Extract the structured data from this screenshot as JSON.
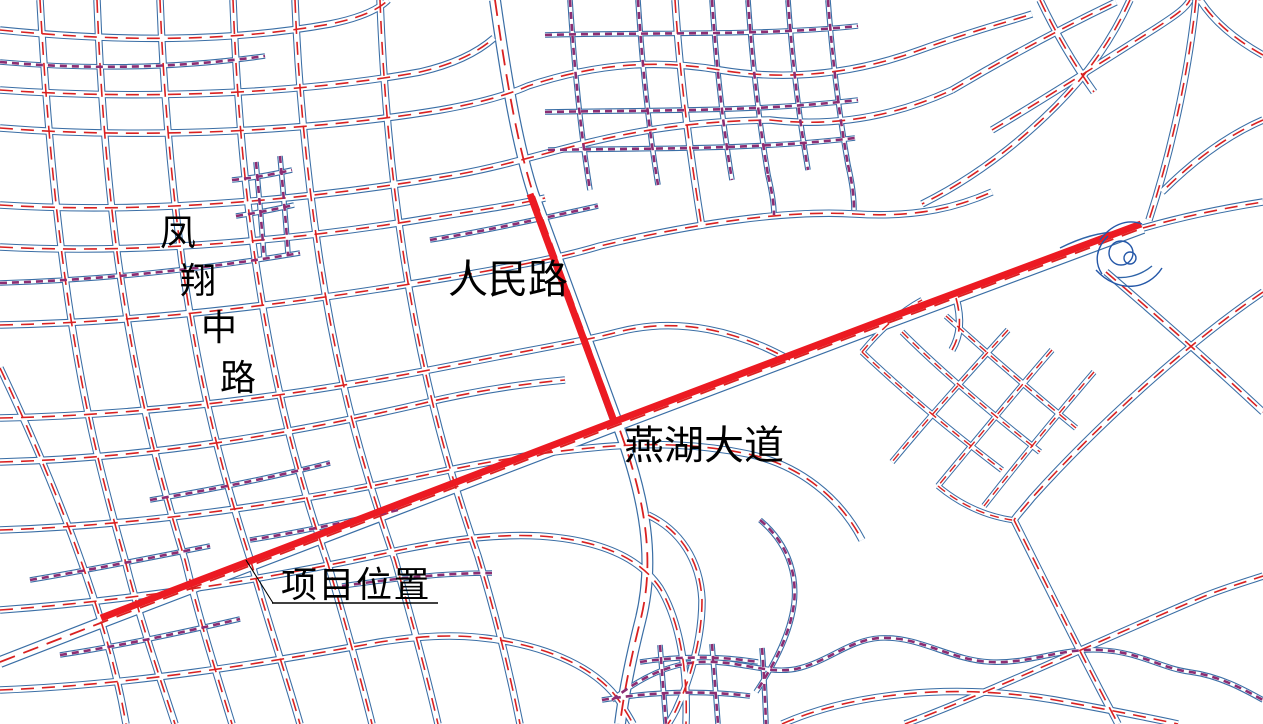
{
  "page": {
    "background": "#ffffff",
    "width": 1263,
    "height": 724
  },
  "colors": {
    "road_edge_blue": "#3a6ea5",
    "centerline_red": "#d92121",
    "minor_street_purple": "#8c2d72",
    "highlight_red": "#ec1a22",
    "label_black": "#000000"
  },
  "labels": {
    "fengxiang_road": {
      "text": "凤翔中路",
      "chars": [
        "凤",
        "翔",
        "中",
        "路"
      ]
    },
    "renmin_road": {
      "text": "人民路"
    },
    "yanhu_avenue": {
      "text": "燕湖大道"
    },
    "project_location": {
      "text": "项目位置"
    }
  },
  "map": {
    "highlight_route_names": [
      "人民路",
      "燕湖大道"
    ],
    "annotation": {
      "leader_d": "M246,560 L273,603",
      "underline_d": "M272,603 L438,603"
    },
    "highlights": [
      "M101,618 L616,421 L878,322 L1141,224",
      "M530,194 L615,424"
    ],
    "interchange": {
      "circles": [
        {
          "cx": 1121,
          "cy": 253,
          "r": 12
        },
        {
          "cx": 1130,
          "cy": 258,
          "r": 6
        }
      ],
      "ramps": [
        "M1096,270 C1118,294 1148,290 1162,268",
        "M1100,240 C1110,226 1126,218 1142,224",
        "M1108,236 C1096,248 1094,262 1102,274"
      ]
    },
    "roads": [
      {
        "c": "M",
        "d": "M0,662 L103,622 L618,425 L880,326 L1143,228"
      },
      {
        "c": "M",
        "d": "M495,0 C505,70 516,140 533,193 L618,425 C645,498 656,560 640,622 C631,658 624,692 620,724"
      },
      {
        "c": "m",
        "d": "M0,30 C120,42 230,42 330,24 C360,18 378,10 388,0"
      },
      {
        "c": "m",
        "d": "M0,90 C140,100 300,94 420,72 C455,64 478,52 494,38"
      },
      {
        "c": "m",
        "d": "M0,128 C150,140 320,130 440,110 C480,103 510,94 528,86 C600,62 660,60 720,70 C792,82 860,72 920,50 C975,30 1008,22 1032,14"
      },
      {
        "c": "m",
        "d": "M0,205 C160,215 330,197 460,174 C552,157 620,122 770,120 C840,128 900,114 952,90"
      },
      {
        "c": "m",
        "d": "M0,247 C150,255 310,238 430,218 C480,210 515,205 545,198"
      },
      {
        "c": "m",
        "d": "M0,325 C160,322 320,300 470,274 C520,265 560,258 600,246 C700,222 790,210 855,214 C920,218 960,206 992,192"
      },
      {
        "c": "m",
        "d": "M0,418 C160,415 320,392 460,364 C540,348 580,342 618,332 C680,316 740,332 790,360"
      },
      {
        "c": "m",
        "d": "M0,462 C150,458 290,434 420,404 C470,392 520,384 565,380"
      },
      {
        "c": "m",
        "d": "M0,530 C150,525 300,502 430,474 C495,460 545,452 590,448 C650,442 700,444 748,454 C800,465 840,498 862,540"
      },
      {
        "c": "m",
        "d": "M0,610 C140,600 280,577 400,550 C460,538 500,534 540,536 C600,540 640,558 660,588 C678,618 688,665 686,724"
      },
      {
        "c": "m",
        "d": "M0,690 C130,685 260,664 380,642 C432,634 470,634 510,642 C560,652 600,672 620,702 C626,712 630,718 633,724"
      },
      {
        "c": "m",
        "d": "M0,368 C40,452 76,540 100,618 C112,656 120,690 126,724"
      },
      {
        "c": "m",
        "d": "M40,0 C45,90 52,180 64,270 C80,392 100,472 125,560 C140,620 158,672 175,724"
      },
      {
        "c": "m",
        "d": "M97,0 C100,80 106,170 118,260 C135,382 158,472 185,560 C200,622 216,672 232,724"
      },
      {
        "c": "m",
        "d": "M160,0 C163,80 170,170 182,262 C200,392 225,482 252,565 C268,622 285,672 300,724"
      },
      {
        "c": "m",
        "d": "M233,0 C236,80 242,168 255,258 C275,394 300,482 328,564 C342,612 358,668 372,724"
      },
      {
        "c": "m",
        "d": "M295,0 C298,80 306,170 320,262 C340,392 368,482 395,560 C410,614 425,668 438,724"
      },
      {
        "c": "m",
        "d": "M380,0 C383,80 390,168 404,258 C425,392 452,480 478,556 C492,602 508,664 520,724"
      },
      {
        "c": "m",
        "d": "M675,0 C680,78 690,155 702,228"
      },
      {
        "c": "n",
        "d": "M570,0 C574,64 580,128 590,190"
      },
      {
        "c": "n",
        "d": "M638,0 C642,62 648,124 658,185"
      },
      {
        "c": "n",
        "d": "M712,0 C716,60 722,120 732,180"
      },
      {
        "c": "n",
        "d": "M748,0 C752,58 758,116 768,175"
      },
      {
        "c": "n",
        "d": "M788,0 C792,56 798,112 808,170"
      },
      {
        "c": "n",
        "d": "M828,0 C832,54 838,108 848,165"
      },
      {
        "c": "n",
        "d": "M545,35 C650,32 760,36 858,26"
      },
      {
        "c": "n",
        "d": "M545,112 C650,110 755,112 858,100"
      },
      {
        "c": "n",
        "d": "M548,150 C650,148 752,150 855,138"
      },
      {
        "c": "n",
        "d": "M768,175 C772,192 774,204 774,215"
      },
      {
        "c": "n",
        "d": "M848,165 C852,182 854,196 854,210"
      },
      {
        "c": "s",
        "d": "M862,352 C902,390 952,432 1002,470"
      },
      {
        "c": "s",
        "d": "M902,332 C942,372 992,414 1040,452"
      },
      {
        "c": "s",
        "d": "M946,316 C986,352 1032,392 1076,428"
      },
      {
        "c": "s",
        "d": "M1008,330 C970,372 930,416 892,462"
      },
      {
        "c": "s",
        "d": "M1052,350 C1014,394 976,440 938,486"
      },
      {
        "c": "s",
        "d": "M1094,372 C1058,414 1020,460 984,506"
      },
      {
        "c": "s",
        "d": "M938,486 C962,506 986,516 1012,520"
      },
      {
        "c": "s",
        "d": "M862,352 C880,330 900,312 922,300"
      },
      {
        "c": "m",
        "d": "M1106,272 C1162,320 1216,368 1263,412"
      },
      {
        "c": "m",
        "d": "M1263,292 C1185,345 1095,428 1032,498 C1024,508 1018,514 1014,520"
      },
      {
        "c": "m",
        "d": "M1014,520 C1040,572 1070,632 1096,682 C1104,698 1112,712 1118,724"
      },
      {
        "c": "m",
        "d": "M905,724 C1000,688 1105,638 1205,596 C1225,588 1245,582 1263,576"
      },
      {
        "c": "m",
        "d": "M782,724 C850,694 950,682 1055,700 C1110,710 1150,718 1178,724"
      },
      {
        "c": "m",
        "d": "M1143,228 C1185,216 1225,208 1263,202"
      },
      {
        "c": "m",
        "d": "M1196,0 C1190,60 1175,140 1149,220"
      },
      {
        "c": "m",
        "d": "M1130,0 C1112,40 1086,76 1056,106 C1012,150 966,182 922,204"
      },
      {
        "c": "m",
        "d": "M1040,0 C1056,34 1074,64 1094,92"
      },
      {
        "c": "m",
        "d": "M952,90 C1006,58 1062,28 1116,2"
      },
      {
        "c": "m",
        "d": "M992,130 C1046,98 1102,62 1156,28 C1176,15 1186,8 1190,0"
      },
      {
        "c": "m",
        "d": "M1263,120 C1226,136 1192,162 1162,192"
      },
      {
        "c": "m",
        "d": "M1263,55 C1236,40 1214,22 1200,0"
      },
      {
        "c": "n",
        "d": "M640,662 C680,656 720,656 758,662"
      },
      {
        "c": "n",
        "d": "M602,700 C650,692 700,690 750,696"
      },
      {
        "c": "n",
        "d": "M660,645 C662,672 664,698 666,724"
      },
      {
        "c": "n",
        "d": "M712,644 C714,670 716,698 718,724"
      },
      {
        "c": "n",
        "d": "M762,648 C764,672 765,698 766,724"
      },
      {
        "c": "n",
        "d": "M612,700 C640,678 668,664 700,662 C740,660 770,676 800,668 C830,660 850,640 880,638 C920,636 950,660 990,662 C1030,664 1060,648 1100,650 C1140,652 1160,668 1190,672 C1220,676 1245,690 1263,700"
      },
      {
        "c": "n",
        "d": "M60,655 C120,646 180,633 240,619"
      },
      {
        "c": "n",
        "d": "M30,580 C90,570 150,558 210,546"
      },
      {
        "c": "n",
        "d": "M150,500 C210,490 270,478 330,463"
      },
      {
        "c": "n",
        "d": "M250,540 C300,532 352,521 402,509"
      },
      {
        "c": "n",
        "d": "M342,586 C392,579 442,573 492,573"
      },
      {
        "c": "n",
        "d": "M0,62 C90,70 180,68 265,56"
      },
      {
        "c": "n",
        "d": "M0,283 C100,280 205,269 300,253"
      },
      {
        "c": "n",
        "d": "M430,240 C480,232 540,219 598,206"
      },
      {
        "c": "n",
        "d": "M232,180 C254,178 274,174 292,170"
      },
      {
        "c": "n",
        "d": "M236,216 C257,213 276,209 294,205"
      },
      {
        "c": "n",
        "d": "M256,162 C259,195 262,228 264,258"
      },
      {
        "c": "n",
        "d": "M280,156 C283,190 286,222 288,254"
      },
      {
        "c": "m",
        "d": "M648,515 C680,530 700,560 702,600 C702,640 690,680 676,710 C672,718 670,721 668,724"
      },
      {
        "c": "n",
        "d": "M760,520 C790,545 800,580 792,615 C786,642 772,668 756,692"
      },
      {
        "c": "m",
        "d": "M956,298 C962,320 960,336 952,350"
      },
      {
        "c": "e",
        "d": "M1060,248 C1080,238 1100,232 1118,232"
      },
      {
        "c": "e",
        "d": "M1108,276 C1124,280 1140,276 1152,266"
      }
    ]
  }
}
